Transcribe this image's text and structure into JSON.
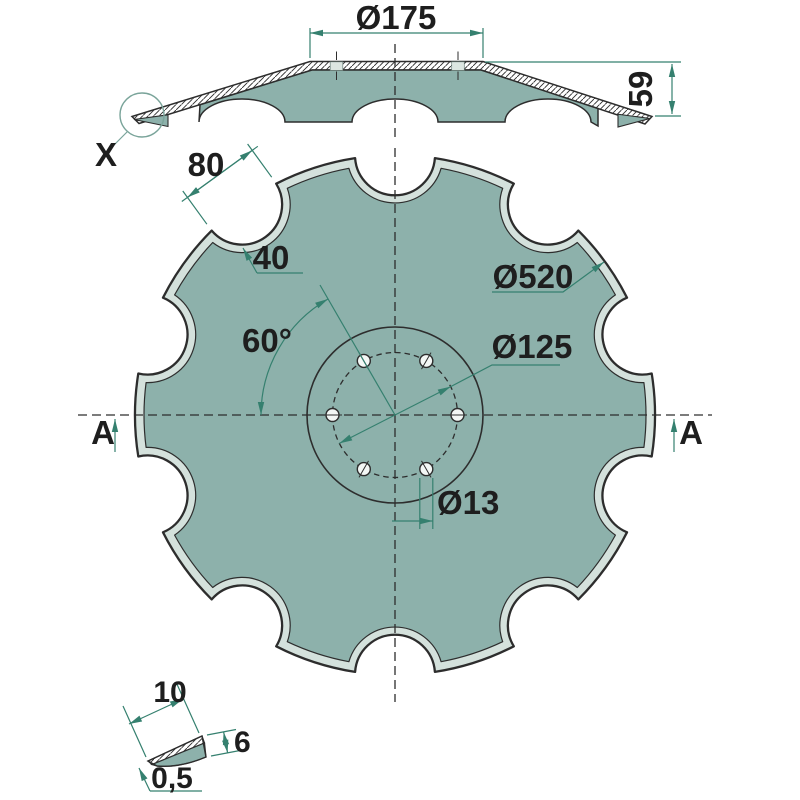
{
  "drawing": {
    "views": {
      "section_view": {
        "flat_diameter": "Ø175",
        "cone_height": "59",
        "detail_marker": "X"
      },
      "front_view": {
        "outer_diameter": "Ø520",
        "bolt_circle_diameter": "Ø125",
        "bolt_hole_diameter": "Ø13",
        "notch_width": "80",
        "notch_depth": "40",
        "hole_spacing_angle": "60°",
        "section_marker_left": "A",
        "section_marker_right": "A",
        "notch_count": 10,
        "bolt_hole_count": 6
      },
      "detail_view": {
        "bevel_length": "10",
        "blade_thickness": "6",
        "edge_thickness": "0,5"
      }
    },
    "colors": {
      "steel_fill": "#8db1ab",
      "bevel_fill": "#d4e1dc",
      "outline": "#2d2d2d",
      "dimension": "#35806f",
      "text": "#1e1e1e",
      "hole_fill": "#f3f7f5",
      "background": "#ffffff"
    }
  }
}
